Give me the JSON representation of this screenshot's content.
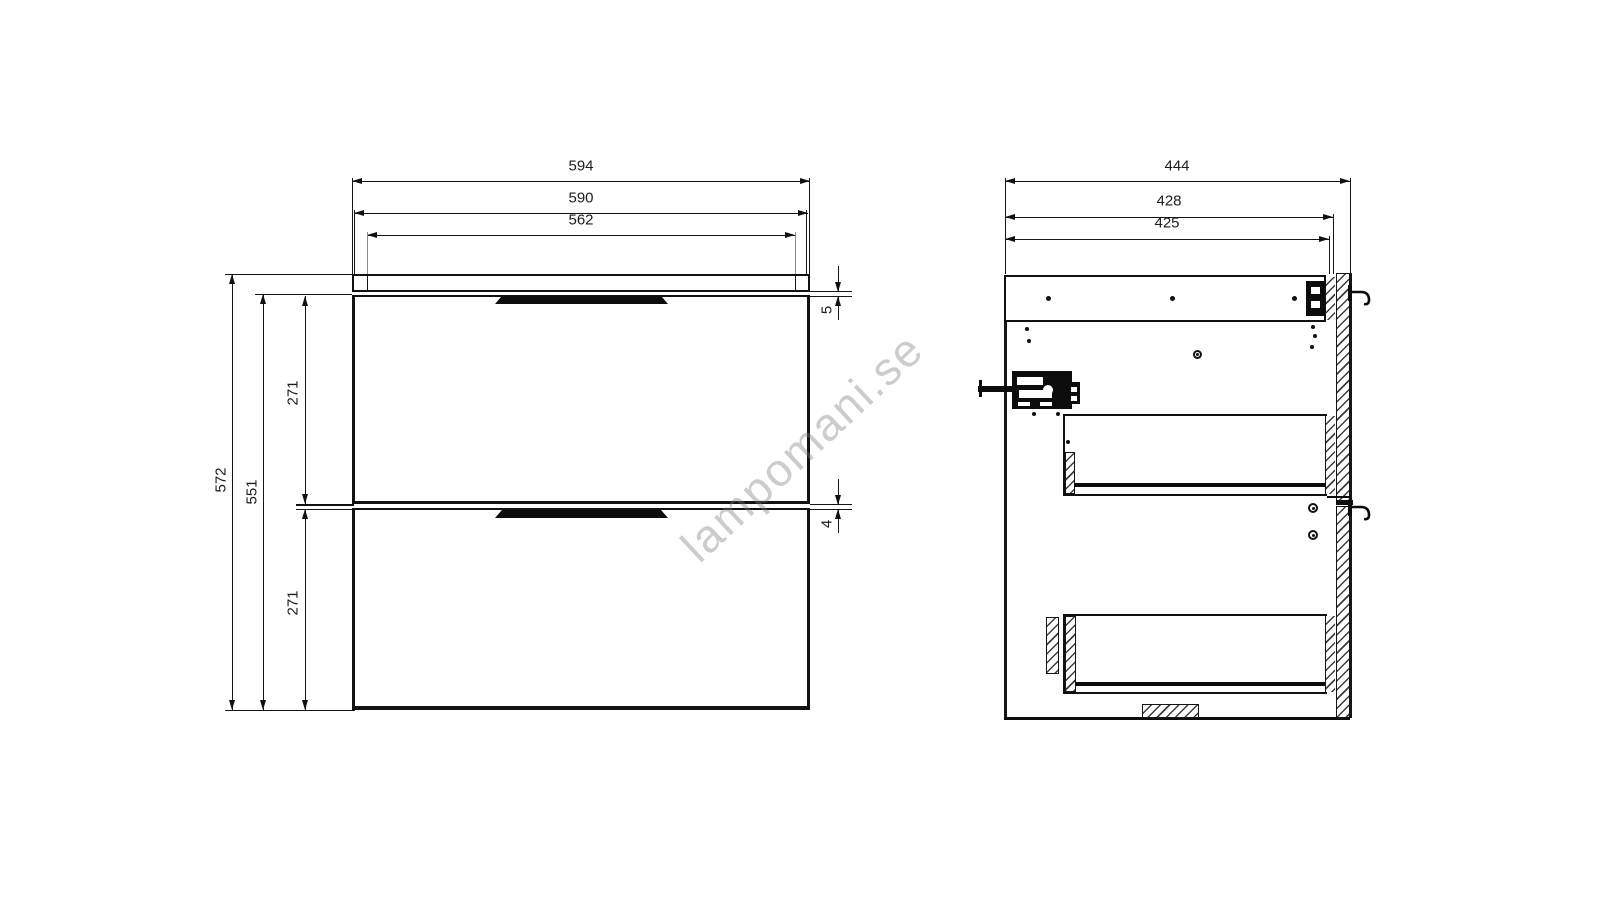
{
  "watermark": {
    "text": "lampomani.se"
  },
  "dims": {
    "front_overall_width": "594",
    "front_cabinet_width": "590",
    "front_top_panel_width": "562",
    "front_overall_height": "572",
    "front_fronts_height": "551",
    "front_upper_drawer_height": "271",
    "front_lower_drawer_height": "271",
    "front_top_gap": "5",
    "front_middle_gap": "4",
    "side_overall_depth": "444",
    "side_carcass_depth": "428",
    "side_inner_depth": "425"
  },
  "colors": {
    "line": "#141414",
    "watermark_grey": "#c9c9c9",
    "background": "#ffffff"
  }
}
